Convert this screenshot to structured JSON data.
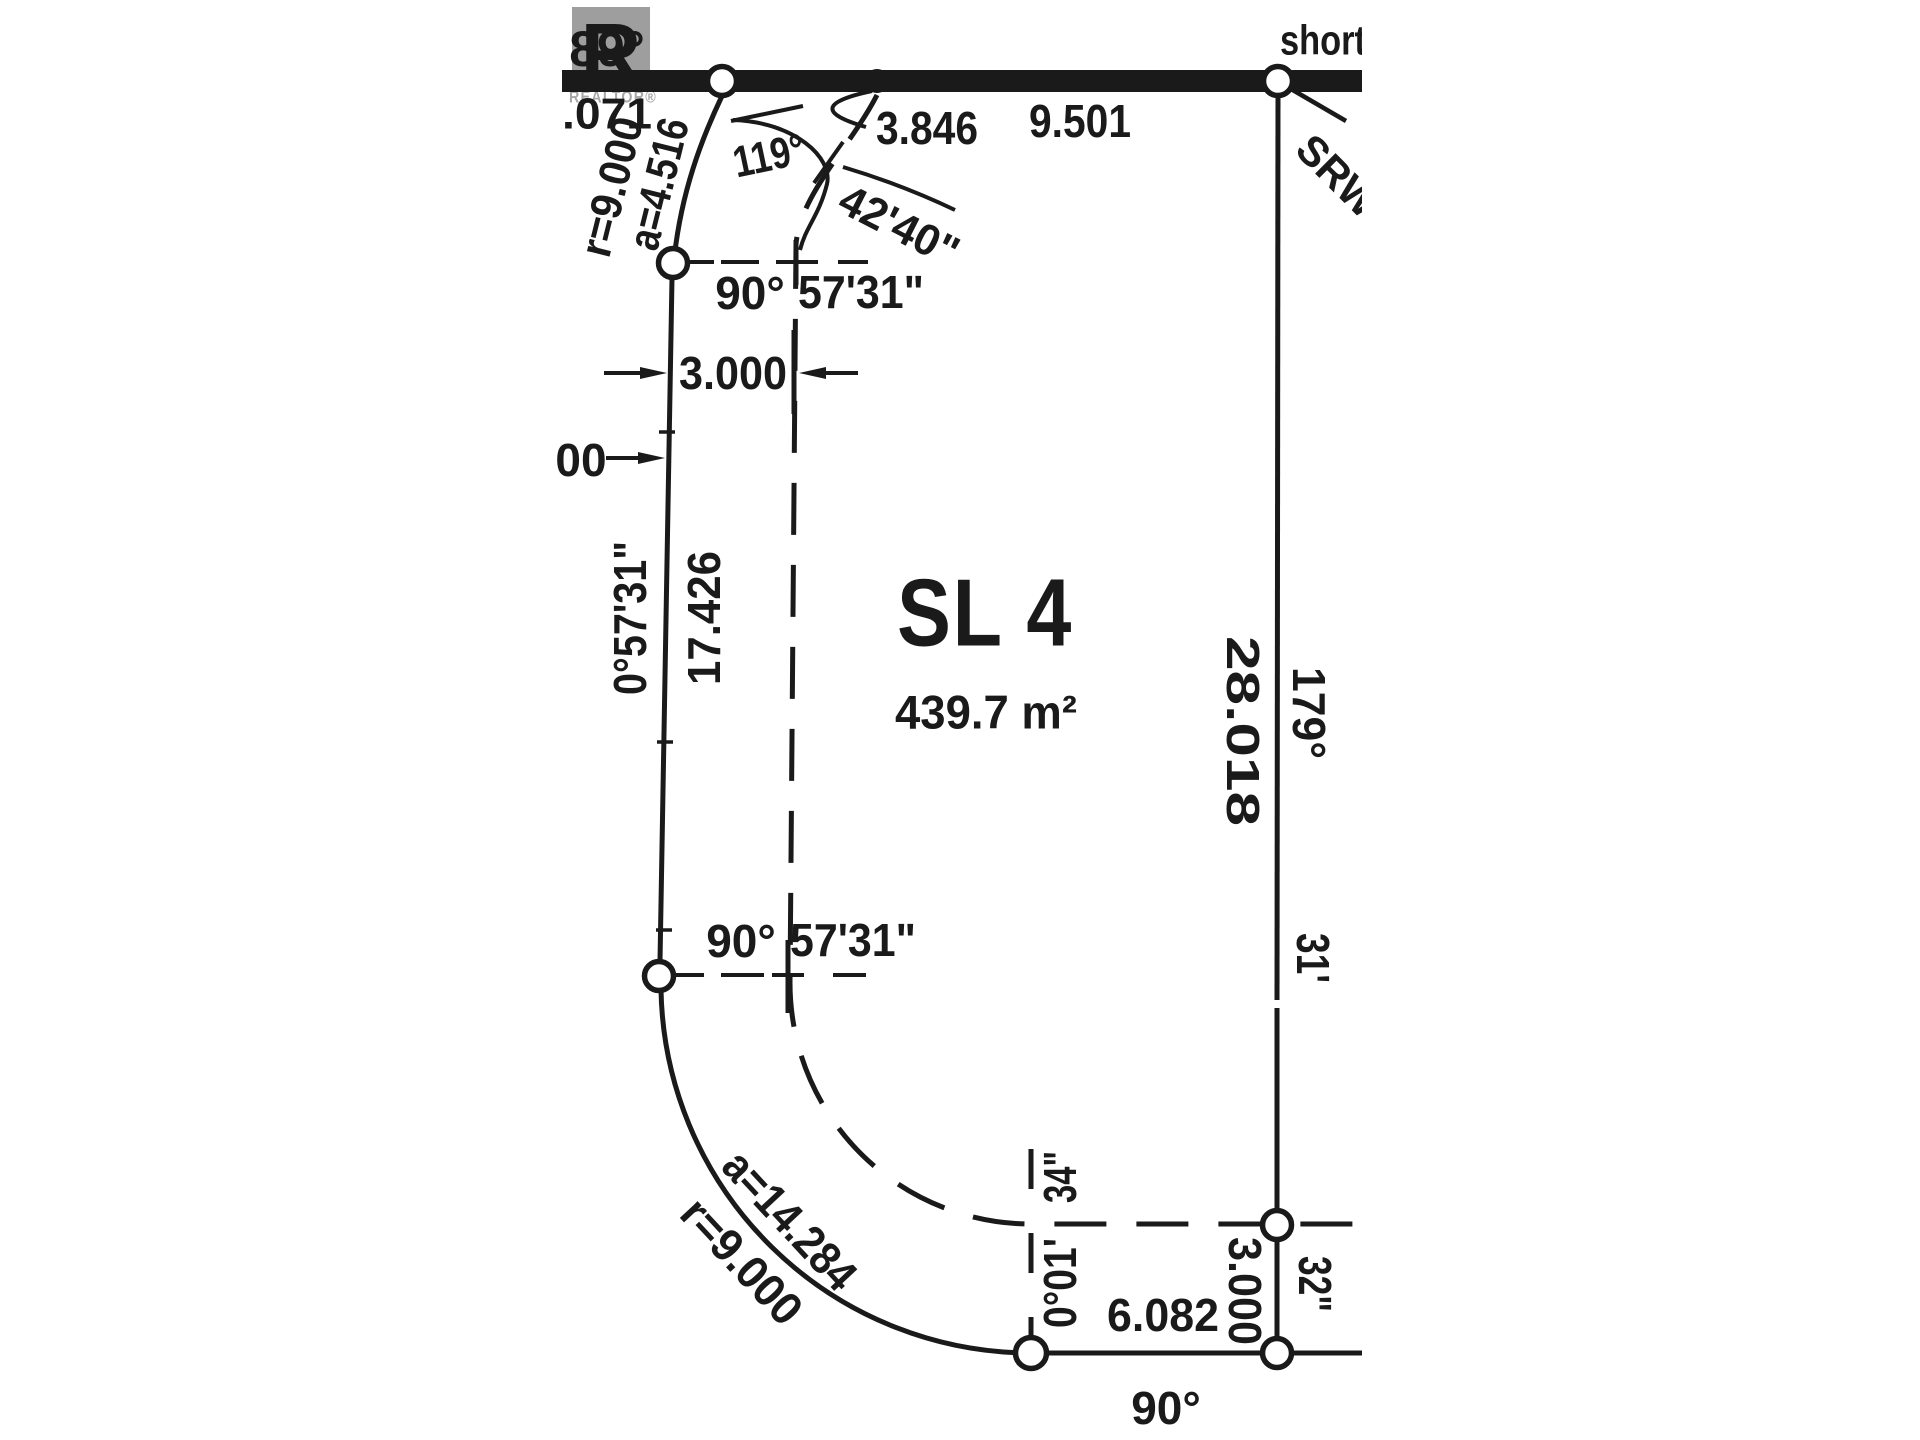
{
  "meta": {
    "type": "survey-plan",
    "colors": {
      "ink": "#1a1a1a",
      "paper": "#ffffff",
      "watermark_gray": "#9e9e9e"
    }
  },
  "watermark": {
    "letter": "R",
    "word": "REALTOR®"
  },
  "lot": {
    "name": "SL 4",
    "area": "439.7 m²"
  },
  "road": {
    "street_label": "short",
    "bearing_left": "89°",
    "dist_left_clipped": ".071",
    "dist_mid": "3.846",
    "dist_right": "9.501",
    "srw_label": "SRW"
  },
  "corner_angle": {
    "deg": "119°",
    "minsec": "42'40\""
  },
  "west_side": {
    "curve_radius": "r=9.000",
    "curve_arc": "a=4.516",
    "angle_deg": "90°",
    "angle_minsec": "57'31\"",
    "setback_dim": "3.000",
    "clipped_dim": "00",
    "bearing": "0°57'31\"",
    "distance": "17.426"
  },
  "south_west_angle": {
    "deg": "90°",
    "minsec": "57'31\""
  },
  "east_side": {
    "distance": "28.018",
    "bearing_deg": "179°",
    "bearing_min": "31'",
    "bearing_sec": "32\"",
    "setback_dist": "3.000"
  },
  "south_curve": {
    "arc": "a=14.284",
    "radius": "r=9.000"
  },
  "south_side": {
    "bearing_deg_min": "0°01'",
    "bearing_sec": "34\"",
    "distance": "6.082",
    "angle": "90°"
  }
}
